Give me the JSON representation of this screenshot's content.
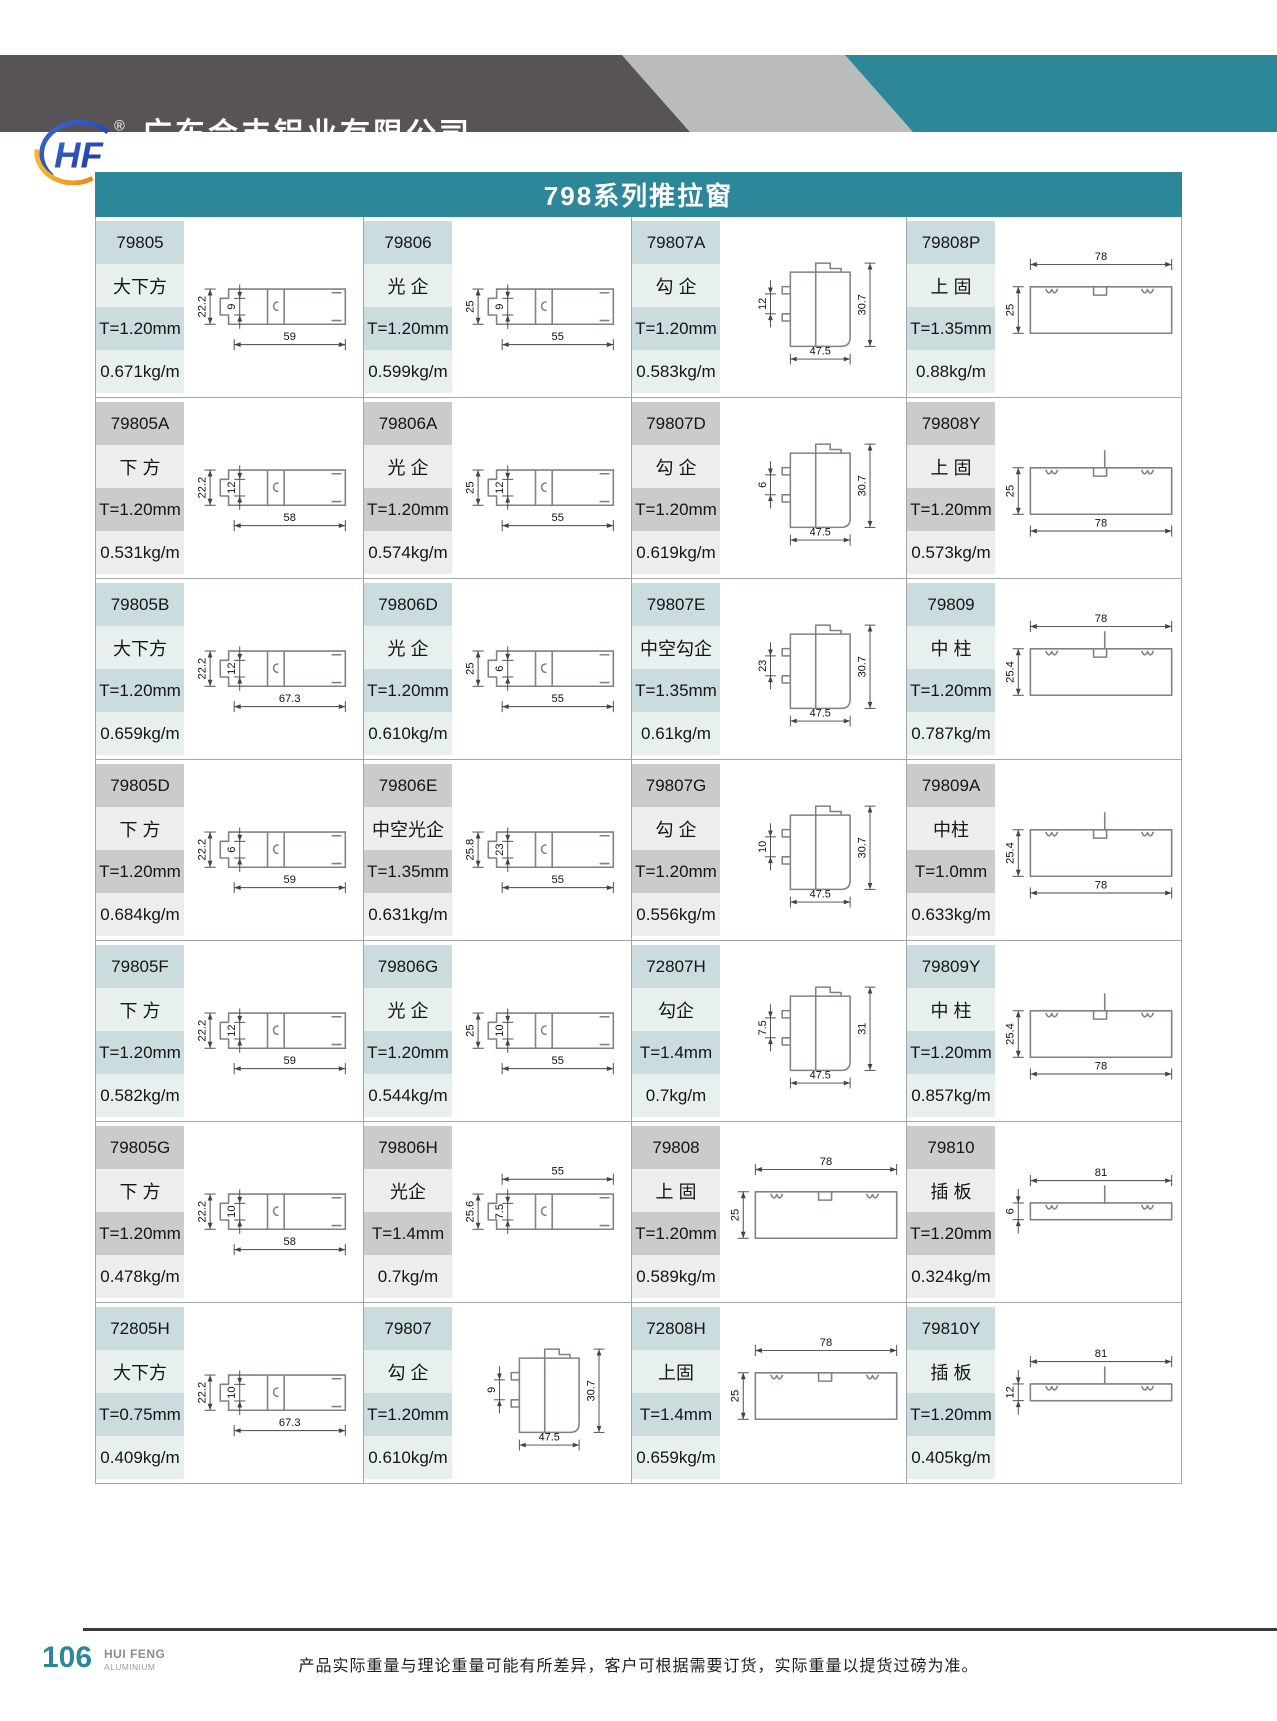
{
  "header": {
    "logo_text": "HF",
    "registered_mark": "®",
    "company_cn": "广东会丰铝业有限公司",
    "company_en": "GUANGDONG HUIFENG ALUMINIUM.,LTD."
  },
  "series_title": "798系列推拉窗",
  "colors": {
    "teal": "#2c8798",
    "header_dark": "#585357",
    "header_light": "#b9bcbb"
  },
  "table": {
    "products": [
      {
        "code": "79805",
        "name": "大下方",
        "thickness": "T=1.20mm",
        "weight": "0.671kg/m",
        "drawing": {
          "type": "rail",
          "dims": {
            "left": "22.2",
            "inner": "9",
            "bottom": "59"
          }
        }
      },
      {
        "code": "79806",
        "name": "光 企",
        "thickness": "T=1.20mm",
        "weight": "0.599kg/m",
        "drawing": {
          "type": "rail",
          "dims": {
            "left": "25",
            "inner": "9",
            "bottom": "55"
          }
        }
      },
      {
        "code": "79807A",
        "name": "勾 企",
        "thickness": "T=1.20mm",
        "weight": "0.583kg/m",
        "drawing": {
          "type": "hook",
          "dims": {
            "inner": "12",
            "right": "30.7",
            "bottom": "47.5"
          }
        }
      },
      {
        "code": "79808P",
        "name": "上 固",
        "thickness": "T=1.35mm",
        "weight": "0.88kg/m",
        "drawing": {
          "type": "wide",
          "dims": {
            "top": "78",
            "left": "25"
          }
        }
      },
      {
        "code": "79805A",
        "name": "下 方",
        "thickness": "T=1.20mm",
        "weight": "0.531kg/m",
        "drawing": {
          "type": "rail",
          "dims": {
            "left": "22.2",
            "inner": "12",
            "bottom": "58"
          }
        }
      },
      {
        "code": "79806A",
        "name": "光 企",
        "thickness": "T=1.20mm",
        "weight": "0.574kg/m",
        "drawing": {
          "type": "rail",
          "dims": {
            "left": "25",
            "inner": "12",
            "bottom": "55"
          }
        }
      },
      {
        "code": "79807D",
        "name": "勾 企",
        "thickness": "T=1.20mm",
        "weight": "0.619kg/m",
        "drawing": {
          "type": "hook",
          "dims": {
            "inner": "6",
            "right": "30.7",
            "bottom": "47.5"
          }
        }
      },
      {
        "code": "79808Y",
        "name": "上 固",
        "thickness": "T=1.20mm",
        "weight": "0.573kg/m",
        "drawing": {
          "type": "wide",
          "dims": {
            "left": "25",
            "bottom": "78"
          },
          "stem": true
        }
      },
      {
        "code": "79805B",
        "name": "大下方",
        "thickness": "T=1.20mm",
        "weight": "0.659kg/m",
        "drawing": {
          "type": "rail",
          "dims": {
            "left": "22.2",
            "inner": "12",
            "bottom": "67.3"
          }
        }
      },
      {
        "code": "79806D",
        "name": "光 企",
        "thickness": "T=1.20mm",
        "weight": "0.610kg/m",
        "drawing": {
          "type": "rail",
          "dims": {
            "left": "25",
            "inner": "6",
            "bottom": "55"
          }
        }
      },
      {
        "code": "79807E",
        "name": "中空勾企",
        "thickness": "T=1.35mm",
        "weight": "0.61kg/m",
        "drawing": {
          "type": "hook",
          "dims": {
            "inner": "23",
            "right": "30.7",
            "bottom": "47.5"
          }
        }
      },
      {
        "code": "79809",
        "name": "中 柱",
        "thickness": "T=1.20mm",
        "weight": "0.787kg/m",
        "drawing": {
          "type": "wide",
          "dims": {
            "top": "78",
            "left": "25.4"
          },
          "stem": true
        }
      },
      {
        "code": "79805D",
        "name": "下 方",
        "thickness": "T=1.20mm",
        "weight": "0.684kg/m",
        "drawing": {
          "type": "rail",
          "dims": {
            "left": "22.2",
            "inner": "6",
            "bottom": "59"
          }
        }
      },
      {
        "code": "79806E",
        "name": "中空光企",
        "thickness": "T=1.35mm",
        "weight": "0.631kg/m",
        "drawing": {
          "type": "rail",
          "dims": {
            "left": "25.8",
            "inner": "23",
            "bottom": "55"
          }
        }
      },
      {
        "code": "79807G",
        "name": "勾 企",
        "thickness": "T=1.20mm",
        "weight": "0.556kg/m",
        "drawing": {
          "type": "hook",
          "dims": {
            "inner": "10",
            "right": "30.7",
            "bottom": "47.5"
          }
        }
      },
      {
        "code": "79809A",
        "name": "中柱",
        "thickness": "T=1.0mm",
        "weight": "0.633kg/m",
        "drawing": {
          "type": "wide",
          "dims": {
            "left": "25.4",
            "bottom": "78"
          },
          "stem": true
        }
      },
      {
        "code": "79805F",
        "name": "下 方",
        "thickness": "T=1.20mm",
        "weight": "0.582kg/m",
        "drawing": {
          "type": "rail",
          "dims": {
            "left": "22.2",
            "inner": "12",
            "bottom": "59"
          }
        }
      },
      {
        "code": "79806G",
        "name": "光 企",
        "thickness": "T=1.20mm",
        "weight": "0.544kg/m",
        "drawing": {
          "type": "rail",
          "dims": {
            "left": "25",
            "inner": "10",
            "bottom": "55"
          }
        }
      },
      {
        "code": "72807H",
        "name": "勾企",
        "thickness": "T=1.4mm",
        "weight": "0.7kg/m",
        "drawing": {
          "type": "hook",
          "dims": {
            "inner": "7.5",
            "right": "31",
            "bottom": "47.5"
          }
        }
      },
      {
        "code": "79809Y",
        "name": "中 柱",
        "thickness": "T=1.20mm",
        "weight": "0.857kg/m",
        "drawing": {
          "type": "wide",
          "dims": {
            "left": "25.4",
            "bottom": "78"
          },
          "stem": true
        }
      },
      {
        "code": "79805G",
        "name": "下 方",
        "thickness": "T=1.20mm",
        "weight": "0.478kg/m",
        "drawing": {
          "type": "rail",
          "dims": {
            "left": "22.2",
            "inner": "10",
            "bottom": "58"
          }
        }
      },
      {
        "code": "79806H",
        "name": "光企",
        "thickness": "T=1.4mm",
        "weight": "0.7kg/m",
        "drawing": {
          "type": "rail",
          "dims": {
            "left": "25.6",
            "inner": "7.5",
            "top": "55"
          }
        }
      },
      {
        "code": "79808",
        "name": "上 固",
        "thickness": "T=1.20mm",
        "weight": "0.589kg/m",
        "drawing": {
          "type": "wide",
          "dims": {
            "top": "78",
            "left": "25"
          }
        }
      },
      {
        "code": "79810",
        "name": "插 板",
        "thickness": "T=1.20mm",
        "weight": "0.324kg/m",
        "drawing": {
          "type": "wide",
          "dims": {
            "top": "81",
            "left": "6"
          },
          "thin": true,
          "stem": true
        }
      },
      {
        "code": "72805H",
        "name": "大下方",
        "thickness": "T=0.75mm",
        "weight": "0.409kg/m",
        "drawing": {
          "type": "rail",
          "dims": {
            "left": "22.2",
            "inner": "10",
            "bottom": "67.3"
          }
        }
      },
      {
        "code": "79807",
        "name": "勾 企",
        "thickness": "T=1.20mm",
        "weight": "0.610kg/m",
        "drawing": {
          "type": "hook",
          "dims": {
            "inner": "9",
            "right": "30.7",
            "bottom": "47.5"
          }
        }
      },
      {
        "code": "72808H",
        "name": "上固",
        "thickness": "T=1.4mm",
        "weight": "0.659kg/m",
        "drawing": {
          "type": "wide",
          "dims": {
            "top": "78",
            "left": "25"
          }
        }
      },
      {
        "code": "79810Y",
        "name": "插 板",
        "thickness": "T=1.20mm",
        "weight": "0.405kg/m",
        "drawing": {
          "type": "wide",
          "dims": {
            "top": "81",
            "left": "12"
          },
          "thin": true,
          "stem": true
        }
      }
    ]
  },
  "footer": {
    "page_number": "106",
    "brand": "HUI FENG",
    "brand_sub": "ALUMINIUM",
    "note": "产品实际重量与理论重量可能有所差异，客户可根据需要订货，实际重量以提货过磅为准。"
  }
}
